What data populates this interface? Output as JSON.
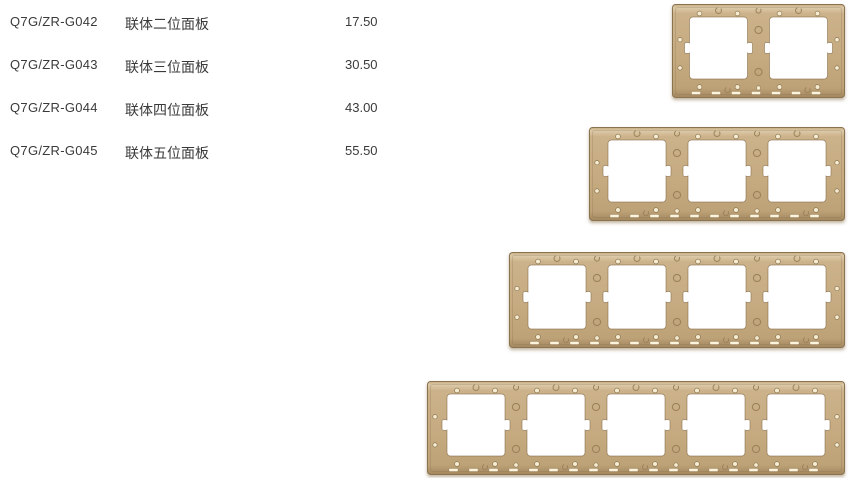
{
  "page": {
    "background": "#ffffff",
    "description": "Product price list page for joined switch panel frames"
  },
  "price_list": {
    "rows": [
      {
        "code": "Q7G/ZR-G042",
        "name": "联体二位面板",
        "price": "17.50",
        "gangs": 2
      },
      {
        "code": "Q7G/ZR-G043",
        "name": "联体三位面板",
        "price": "30.50",
        "gangs": 3
      },
      {
        "code": "Q7G/ZR-G044",
        "name": "联体四位面板",
        "price": "43.00",
        "gangs": 4
      },
      {
        "code": "Q7G/ZR-G045",
        "name": "联体五位面板",
        "price": "55.50",
        "gangs": 5
      }
    ]
  },
  "product_images": {
    "finish": "gold",
    "colors": {
      "base": "#c6ab81",
      "highlight": "#dccaa9",
      "midlight": "#ccb28a",
      "lowdark": "#bda177",
      "bottom_dark": "#a2875f",
      "edge": "#8a7450",
      "rim": "#8f7652",
      "hole": "#f6ecd2",
      "hole_rim": "#8f7954",
      "ring": "#9b835a",
      "slot": "#fdf4dd",
      "opening": "#ffffff"
    },
    "panels": [
      {
        "label": "2-gang joined panel frame",
        "gangs": 2
      },
      {
        "label": "3-gang joined panel frame",
        "gangs": 3
      },
      {
        "label": "4-gang joined panel frame",
        "gangs": 4
      },
      {
        "label": "5-gang joined panel frame",
        "gangs": 5
      }
    ]
  }
}
